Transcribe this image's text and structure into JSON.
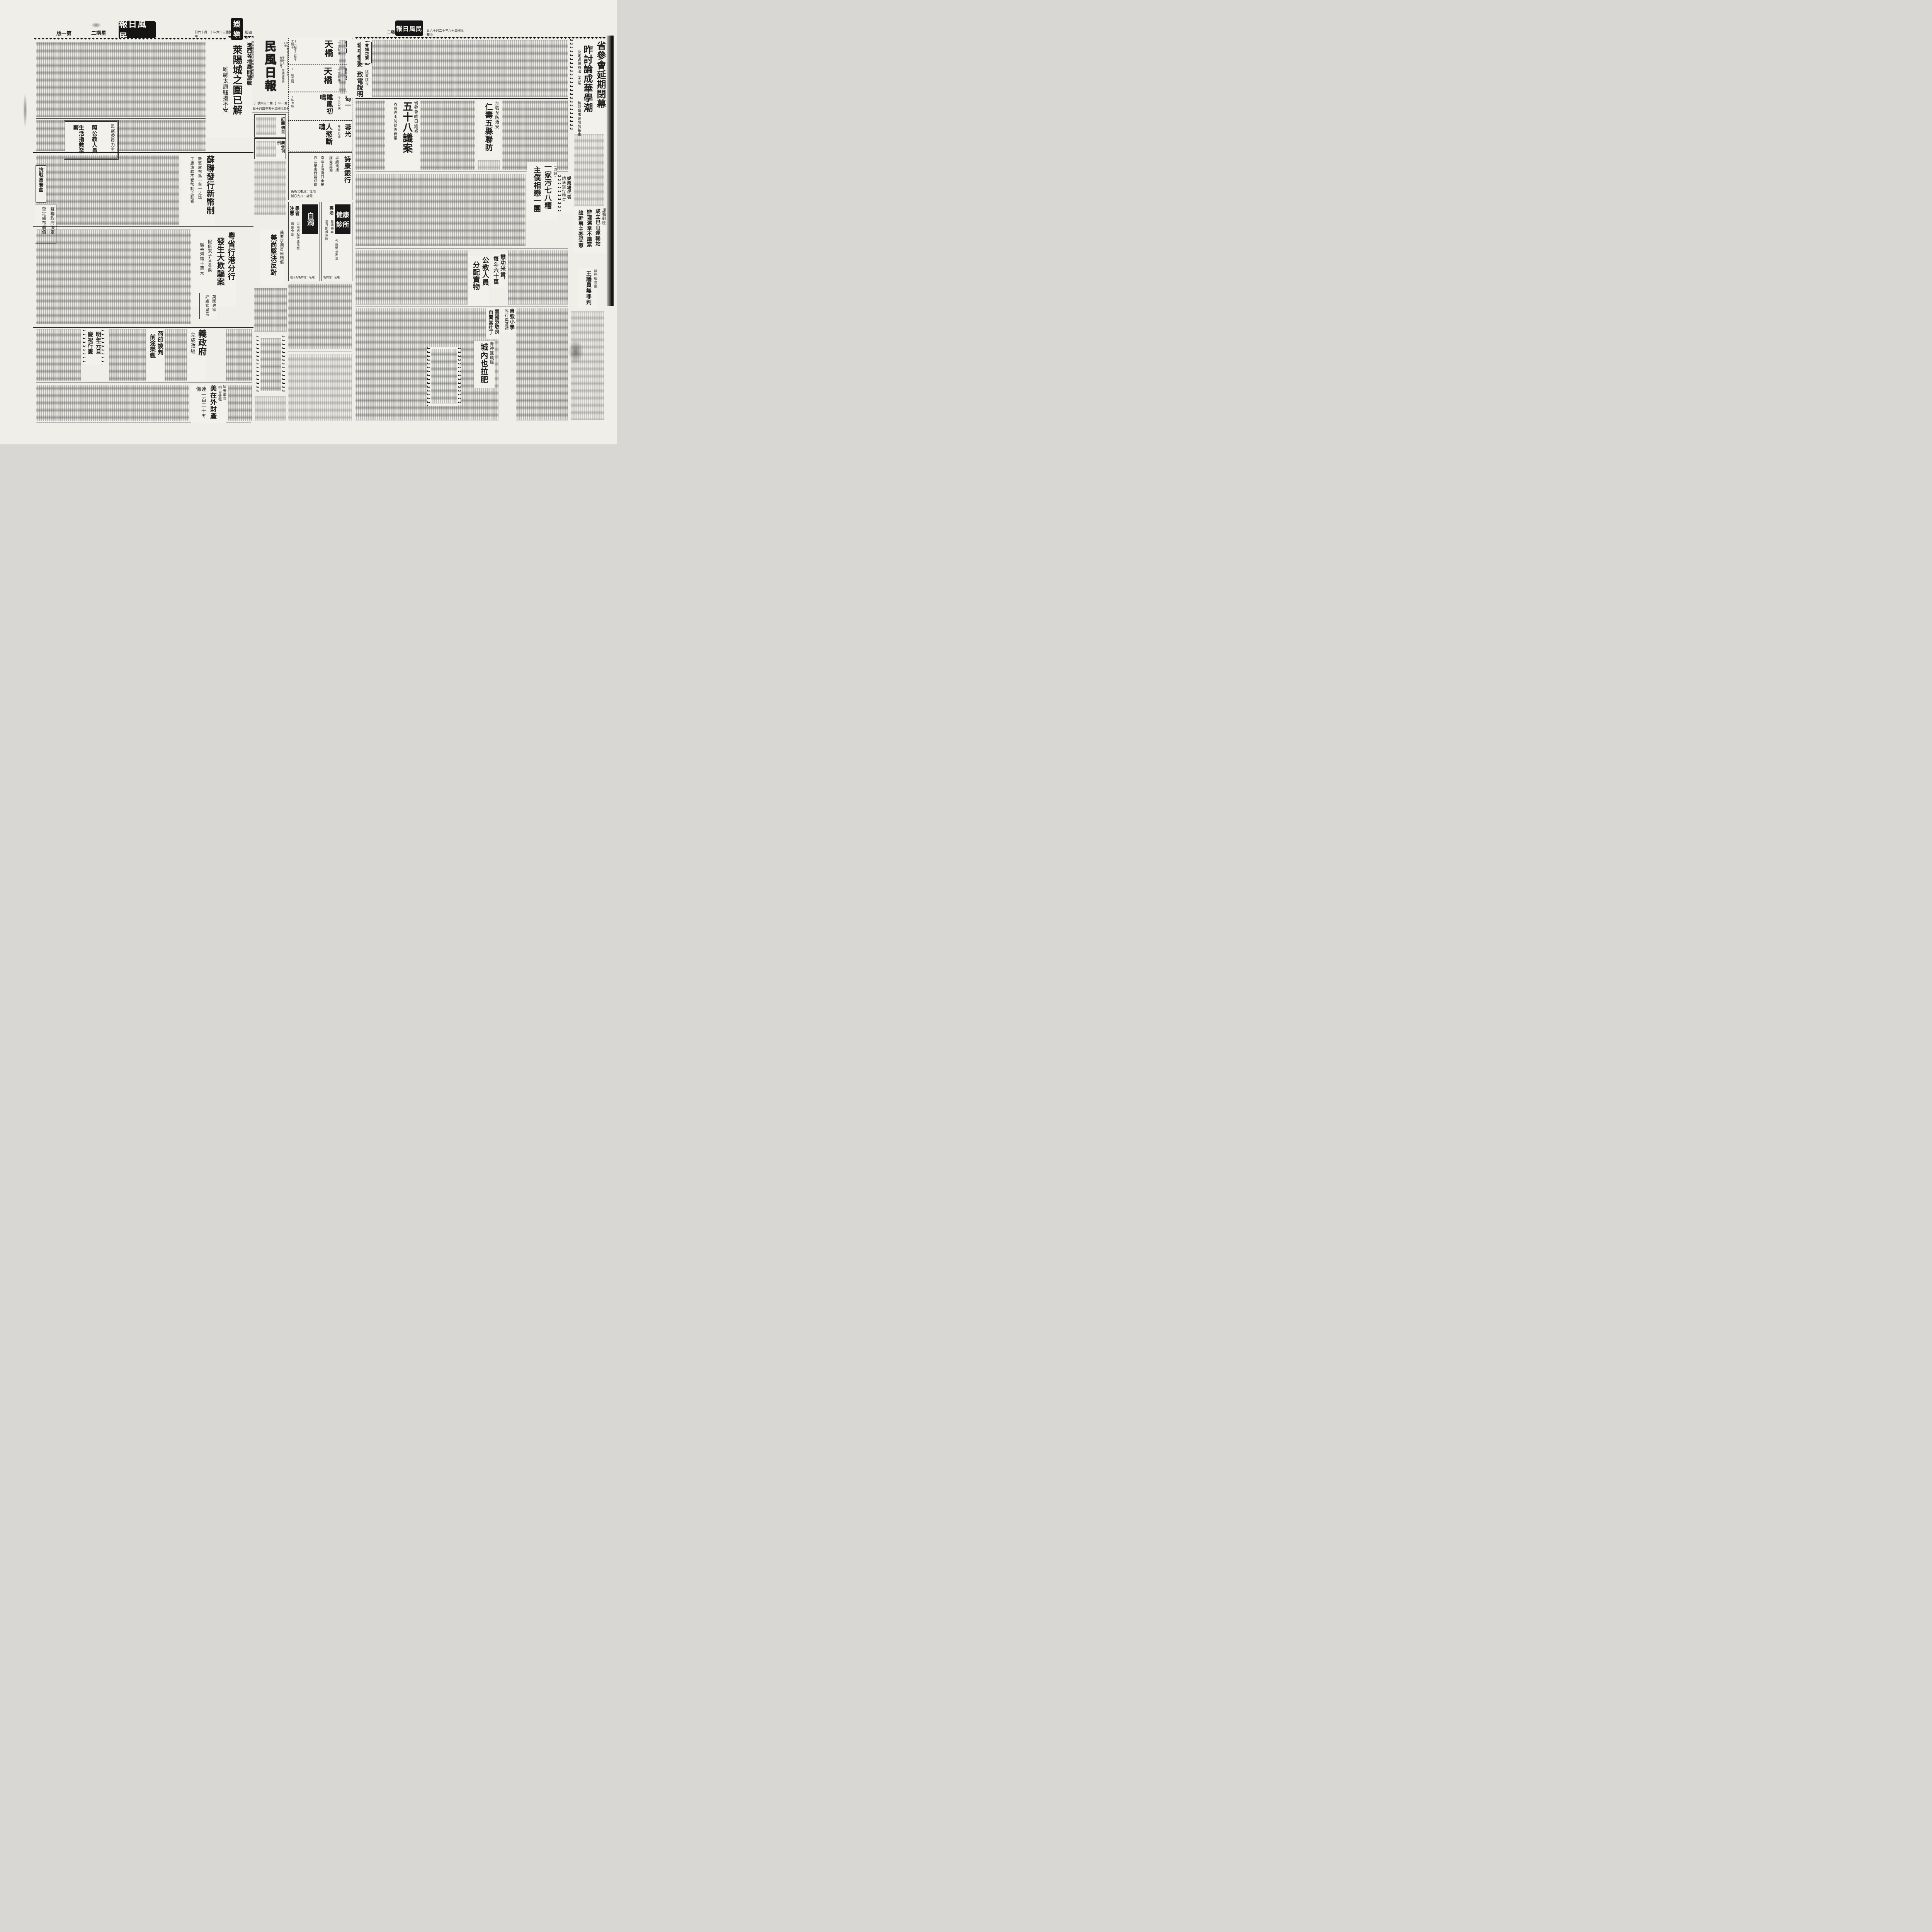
{
  "paper": {
    "name": "民風日報",
    "date": "中華民國三十六年十二月十六日",
    "weekday": "星期二"
  },
  "left_page": {
    "header": {
      "page_label": "第一版",
      "weekday": "星期二",
      "logo": "民風日報",
      "date": "中華民國三十六年十二月十六日",
      "section_stamp_top": "娛",
      "section_stamp_bottom": "樂",
      "section_page_label": "第四版"
    },
    "liaoxi": {
      "kicker": "遼西各地展開激戰",
      "title": "萊陽城之圍已解",
      "sub": "雎縣太康騷擾不安"
    },
    "postal_line": "中華郵政登記認為新聞紙類",
    "jiancha_box": {
      "line1": "監察委員力主",
      "line2": "照公教人員",
      "line3": "生活指數發薪"
    },
    "sulian": {
      "title": "蘇聯發行新幣制",
      "sub1": "新舊盧布爲一與十之比",
      "sub2": "工農進款不受幣制之影響"
    },
    "kangzhan_box": "抗戰馬賽曲",
    "sulian_box": {
      "line1": "蘇聯政府決定",
      "line2": "重定盧布價值"
    },
    "yue_bank": {
      "title1": "粵省行港分行",
      "title2": "發生大欺騙案",
      "sub1": "假借宋子文名義",
      "sub2": "騙去港幣十萬元"
    },
    "mei_oppose": {
      "kicker": "蘇要求德百億賠償",
      "title": "美尚堅決反對"
    },
    "uk_expert": {
      "line1": "英國專家",
      "line2": "評處女皇島"
    },
    "italy": {
      "title": "義政府",
      "sub": "完成改組"
    },
    "heyin": {
      "title1": "荷印談判",
      "title2": "前途樂觀"
    },
    "xianzheng_box": {
      "line1": "明年元旦",
      "line2": "慶祝行憲"
    },
    "us_property": {
      "kicker1": "留美軍官",
      "kicker2": "明日啓程",
      "title": "美在外財產",
      "sub": "達一百二十五億"
    }
  },
  "center": {
    "masthead": {
      "title": "民風日報",
      "postal": "中華郵政登記認為新聞紙類",
      "registration": "內政部登記證京警川字第七〇號",
      "publisher": "發行人·民風報股份有限公司",
      "issue_label": "（第二三四號）",
      "year_label": "（第一年）",
      "founded": "創刊於民國三十五年四月十日"
    },
    "price_box1": "訂閱價目",
    "price_box2": "廣告刊例",
    "cinema_ads": [
      {
        "cinema": "智育",
        "film": "天橋",
        "note": "今天獻映",
        "times": "十一點半二點半五點半"
      },
      {
        "cinema": "國民",
        "film": "天橋",
        "note": "今天獻映",
        "times": "十一點三點"
      },
      {
        "cinema": "蜀一",
        "film": "雛鳳初鳴",
        "note": "今天公映",
        "times": "五點七點"
      },
      {
        "cinema": "蓉光",
        "film": "人慾斷魂",
        "note": "今天公映",
        "times": ""
      }
    ],
    "bank_ad": {
      "name": "詩康銀行",
      "feature1": "手續簡捷",
      "feature2": "匯兌靈通",
      "branches1": "南京上海漢口重慶",
      "branches2": "內江樂山西昌成都",
      "address": "地址：成都北新街",
      "phone": "電話：八九〇號"
    },
    "clinic_ad1": {
      "name1": "健康",
      "name2": "診所",
      "sub": "專治",
      "line1": "白濁梅毒",
      "line2": "三日斷根保險",
      "line3": "包皮過長割治",
      "address": "地址：總府街"
    },
    "clinic_ad2": {
      "name": "白濁",
      "sub1": "患者",
      "sub2": "注意",
      "line1": "白濁初起徹底除根",
      "line2": "限期全愈",
      "address": "地址：總府街九十號"
    }
  },
  "right_page": {
    "header": {
      "weekday": "星期二",
      "logo": "民風日報",
      "date": "中華民國三十六年十二月十六日"
    },
    "lead": {
      "title1": "省參會延期閉幕",
      "title2": "昨討論成華學潮",
      "sub1": "決定處理辦法三大案",
      "sub2": "聽取理事會增加基金"
    },
    "huaxu_box": "會場花絮",
    "dachao": {
      "title1": "發行大鈔",
      "title2": "發乎需要",
      "kicker": "張羣院長",
      "title3": "致電說明"
    },
    "yian": {
      "kicker": "省參會昨日通過",
      "title": "五十八議案",
      "sub": "內有巴山防務等要案"
    },
    "lianfang": {
      "kicker": "加強冬防治安",
      "title": "仁壽五縣聯防"
    },
    "zhupu": {
      "kicker": "（渝訊）",
      "title1": "一家污七八糟",
      "title2": "主僕相戀一團"
    },
    "yule_box": {
      "line1": "娛樂場代表",
      "line2": "請速撥付積欠"
    },
    "edge_block": {
      "line1": "加強剿匪",
      "line2": "成立巴山運輸站",
      "line3": "辦理選舉不講票",
      "line4": "總幹事主委受懲"
    },
    "gongjiao": {
      "title1": "公教人員",
      "title2": "分配實物"
    },
    "maogong": {
      "title1": "懋功米貴，",
      "title2": "每斗六十萬"
    },
    "wuzui": {
      "kicker": "毆死稅官案",
      "title": "王議員無罪判"
    },
    "ziqiang": {
      "title": "自強小學",
      "sub": "昨行奠基禮"
    },
    "yunyang": {
      "line1": "雲陽張敬良",
      "line2": "自賣當壯丁"
    },
    "qingshen": {
      "kicker": "青神匪風熾",
      "title": "城內也拉肥"
    }
  }
}
